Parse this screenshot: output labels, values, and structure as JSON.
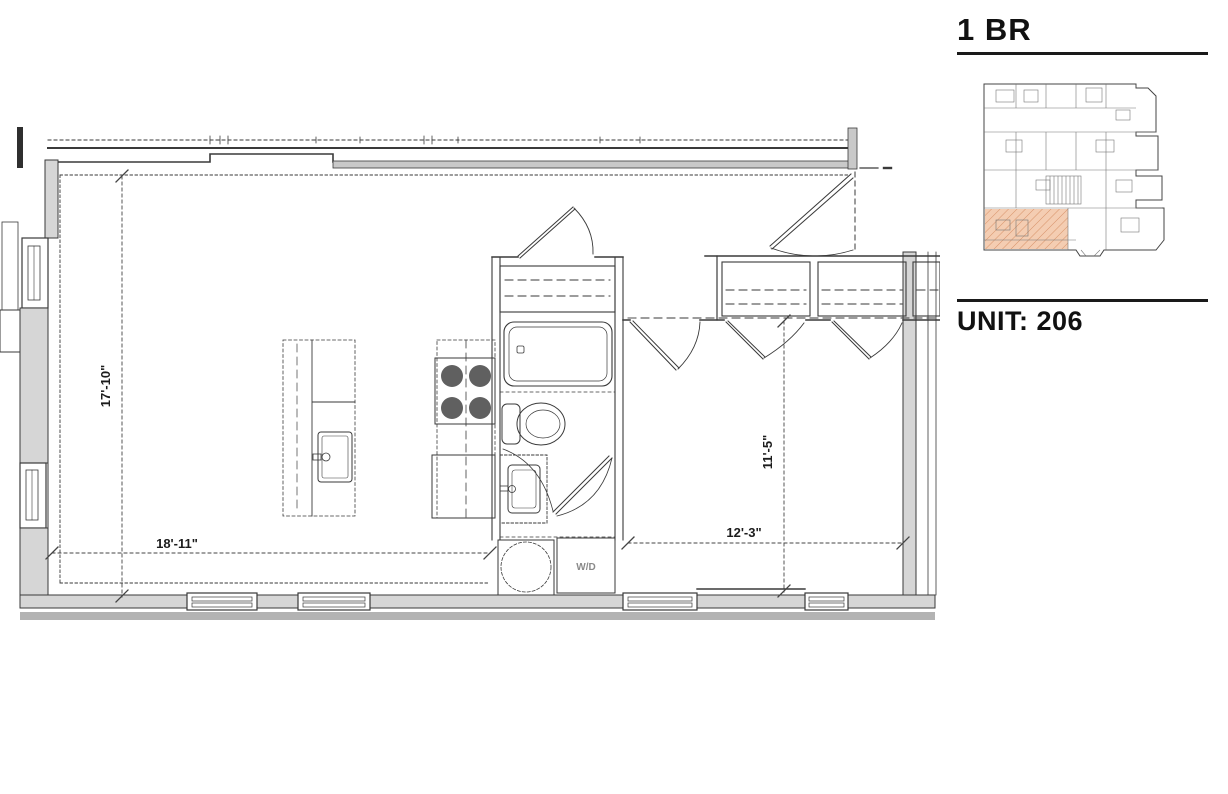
{
  "sidebar": {
    "plan_type": "1 BR",
    "unit_label": "UNIT: 206"
  },
  "dimensions": {
    "living_width": "18'-11\"",
    "living_depth": "17'-10\"",
    "bedroom_width": "12'-3\"",
    "bedroom_depth": "11'-5\""
  },
  "labels": {
    "washer_dryer": "W/D"
  },
  "colors": {
    "line": "#3a3a3a",
    "wall_fill": "#d6d6d6",
    "hatch_band": "#b3b3b3",
    "highlight": "#f4cdb2",
    "highlight_hatch": "#d8936a",
    "heading": "#111111"
  }
}
